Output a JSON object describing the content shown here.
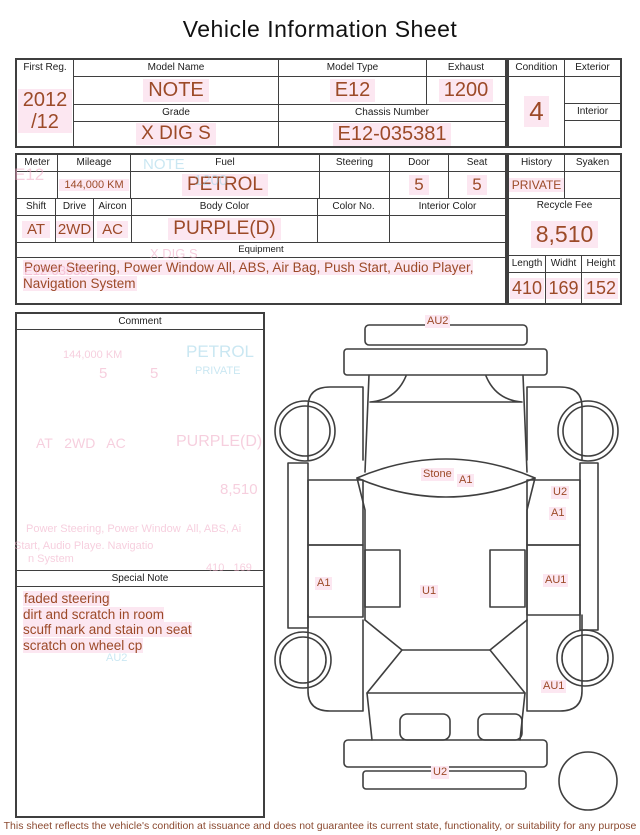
{
  "title": "Vehicle Information Sheet",
  "fields": {
    "first_reg": {
      "label": "First Reg.",
      "value": "2012\n/12"
    },
    "model_name": {
      "label": "Model Name",
      "value": "NOTE"
    },
    "model_type": {
      "label": "Model Type",
      "value": "E12"
    },
    "exhaust": {
      "label": "Exhaust",
      "value": "1200"
    },
    "grade": {
      "label": "Grade",
      "value": "X DIG S"
    },
    "chassis_number": {
      "label": "Chassis Number",
      "value": "E12-035381"
    },
    "condition": {
      "label": "Condition",
      "value": "4"
    },
    "exterior": {
      "label": "Exterior",
      "value": ""
    },
    "interior": {
      "label": "Interior",
      "value": ""
    },
    "meter": {
      "label": "Meter",
      "value": ""
    },
    "mileage": {
      "label": "Mileage",
      "value": "144,000 KM"
    },
    "fuel": {
      "label": "Fuel",
      "value": "PETROL"
    },
    "steering": {
      "label": "Steering",
      "value": ""
    },
    "door": {
      "label": "Door",
      "value": "5"
    },
    "seat": {
      "label": "Seat",
      "value": "5"
    },
    "history": {
      "label": "History",
      "value": "PRIVATE"
    },
    "syaken": {
      "label": "Syaken",
      "value": ""
    },
    "shift": {
      "label": "Shift",
      "value": "AT"
    },
    "drive": {
      "label": "Drive",
      "value": "2WD"
    },
    "aircon": {
      "label": "Aircon",
      "value": "AC"
    },
    "body_color": {
      "label": "Body Color",
      "value": "PURPLE(D)"
    },
    "color_no": {
      "label": "Color No.",
      "value": ""
    },
    "interior_color": {
      "label": "Interior Color",
      "value": ""
    },
    "recycle_fee": {
      "label": "Recycle Fee",
      "value": "8,510"
    },
    "length": {
      "label": "Length",
      "value": "410"
    },
    "width": {
      "label": "Widht",
      "value": "169"
    },
    "height": {
      "label": "Height",
      "value": "152"
    }
  },
  "equipment": {
    "label": "Equipment",
    "value": "Power Steering, Power Window  All, ABS, Air Bag, Push Start, Audio Player, Navigation System"
  },
  "comment": {
    "label": "Comment",
    "value": ""
  },
  "special_note": {
    "label": "Special Note",
    "value": "faded steering\ndirt and scratch in room\nscuff mark and stain on seat\nscratch on wheel cp"
  },
  "footer": {
    "text": "This sheet reflects the vehicle's condition at issuance and does not guarantee its current state, functionality, or suitability for any purpose"
  },
  "diagram": {
    "labels": [
      {
        "text": "AU2",
        "x": 425,
        "y": 315
      },
      {
        "text": "Stone",
        "x": 421,
        "y": 468
      },
      {
        "text": "A1",
        "x": 457,
        "y": 474
      },
      {
        "text": "U2",
        "x": 551,
        "y": 486
      },
      {
        "text": "A1",
        "x": 549,
        "y": 507
      },
      {
        "text": "A1",
        "x": 315,
        "y": 577
      },
      {
        "text": "U1",
        "x": 420,
        "y": 585
      },
      {
        "text": "AU1",
        "x": 543,
        "y": 574
      },
      {
        "text": "AU1",
        "x": 541,
        "y": 680
      },
      {
        "text": "U2",
        "x": 431,
        "y": 766
      }
    ]
  },
  "ghosts": [
    {
      "text": "E12",
      "x": 14,
      "y": 166,
      "size": 17,
      "tone": "pink"
    },
    {
      "text": "NOTE",
      "x": 143,
      "y": 157,
      "size": 15,
      "tone": "blue"
    },
    {
      "text": "1200",
      "x": 194,
      "y": 173,
      "size": 15,
      "tone": "blue"
    },
    {
      "text": "X DIG S",
      "x": 150,
      "y": 247,
      "size": 13,
      "tone": "pink"
    },
    {
      "text": "E12-035381",
      "x": 24,
      "y": 264,
      "size": 13,
      "tone": "pink"
    },
    {
      "text": "144,000 KM",
      "x": 63,
      "y": 350,
      "size": 11,
      "tone": "pink"
    },
    {
      "text": "5",
      "x": 99,
      "y": 366,
      "size": 15,
      "tone": "pink"
    },
    {
      "text": "5",
      "x": 150,
      "y": 366,
      "size": 15,
      "tone": "pink"
    },
    {
      "text": "PETROL",
      "x": 186,
      "y": 343,
      "size": 17,
      "tone": "blue"
    },
    {
      "text": "PRIVATE",
      "x": 195,
      "y": 366,
      "size": 11,
      "tone": "blue"
    },
    {
      "text": "AT   2WD   AC",
      "x": 36,
      "y": 436,
      "size": 14,
      "tone": "pink"
    },
    {
      "text": "PURPLE(D)",
      "x": 176,
      "y": 434,
      "size": 16,
      "tone": "pink"
    },
    {
      "text": "8,510",
      "x": 220,
      "y": 482,
      "size": 15,
      "tone": "pink"
    },
    {
      "text": "Power Steering, Power Window  All, ABS, Ai",
      "x": 26,
      "y": 524,
      "size": 11,
      "tone": "pink"
    },
    {
      "text": "Start, Audio Playe. Navigatio",
      "x": 14,
      "y": 541,
      "size": 11,
      "tone": "pink"
    },
    {
      "text": "n System",
      "x": 28,
      "y": 554,
      "size": 11,
      "tone": "pink"
    },
    {
      "text": "410   169",
      "x": 206,
      "y": 563,
      "size": 11,
      "tone": "pink"
    },
    {
      "text": "AU2",
      "x": 106,
      "y": 653,
      "size": 11,
      "tone": "blue"
    }
  ],
  "colors": {
    "value_text": "#9c4a28",
    "highlight_pink": "#fce7f1",
    "border": "#3f3f3f",
    "ghost_pink": "#f0a8c4",
    "ghost_blue": "#9fd4e8",
    "footer_text": "#8b4a30"
  }
}
